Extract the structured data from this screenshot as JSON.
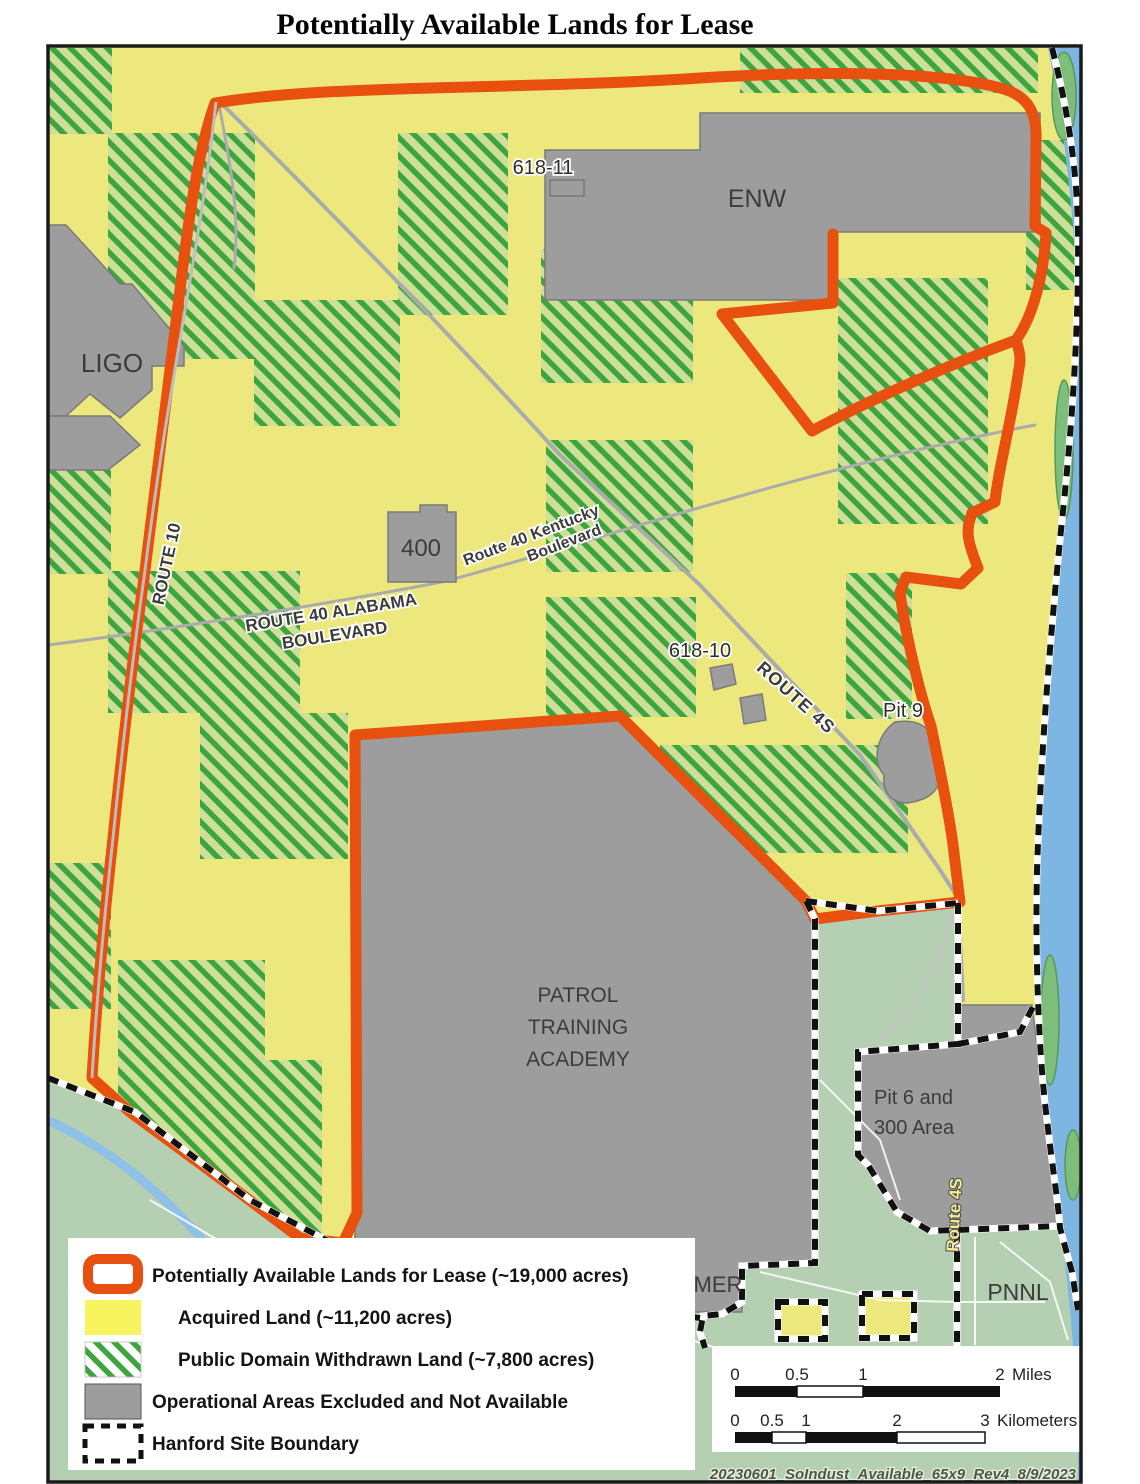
{
  "title": "Potentially Available Lands for Lease",
  "map": {
    "area_labels": {
      "enw": "ENW",
      "ligo": "LIGO",
      "area400": "400",
      "b61811": "618-11",
      "b61810": "618-10",
      "pit9": "Pit 9",
      "pit6_line1": "Pit 6 and",
      "pit6_line2": "300 Area",
      "patrol_line1": "PATROL",
      "patrol_line2": "TRAINING",
      "patrol_line3": "ACADEMY",
      "hammer_partial": "MER",
      "pnnl": "PNNL"
    },
    "road_labels": {
      "route10": "ROUTE 10",
      "route40_kentucky_line1": "Route 40 Kentucky",
      "route40_kentucky_line2": "Boulevard",
      "route40_alabama_line1": "ROUTE 40 ALABAMA",
      "route40_alabama_line2": "BOULEVARD",
      "route4s": "ROUTE 4S",
      "route4s_south": "Route 4S"
    },
    "caption": "20230601_SoIndust_Available_65x9_Rev4_8/9/2023"
  },
  "legend": {
    "items": [
      {
        "label": "Potentially Available Lands for Lease (~19,000 acres)",
        "swatch": "lease-outline"
      },
      {
        "label": "Acquired Land (~11,200 acres)",
        "swatch": "acquired-yellow"
      },
      {
        "label": "Public Domain Withdrawn Land (~7,800 acres)",
        "swatch": "withdrawn-hatch"
      },
      {
        "label": "Operational Areas Excluded and Not Available",
        "swatch": "operational-gray"
      },
      {
        "label": "Hanford Site Boundary",
        "swatch": "site-boundary-dash"
      }
    ]
  },
  "scalebar": {
    "miles": {
      "t0": "0",
      "t1": "0.5",
      "t2": "1",
      "t3": "2",
      "unit": "Miles"
    },
    "kilometers": {
      "t0": "0",
      "t1": "0.5",
      "t2": "1",
      "t3": "2",
      "t4": "3",
      "unit": "Kilometers"
    }
  },
  "colors": {
    "lease_boundary": "#E8500F",
    "acquired_land": "#F7F45F",
    "map_yellow": "#EDE87E",
    "withdrawn_stripe": "#3EA43E",
    "hatch_background": "#CDDF98",
    "operational_gray": "#9D9D9D",
    "terrain_sage": "#B5CFB2",
    "river_blue": "#7EB6E3",
    "island_green": "#7CBE7A",
    "site_boundary_black": "#111111"
  }
}
